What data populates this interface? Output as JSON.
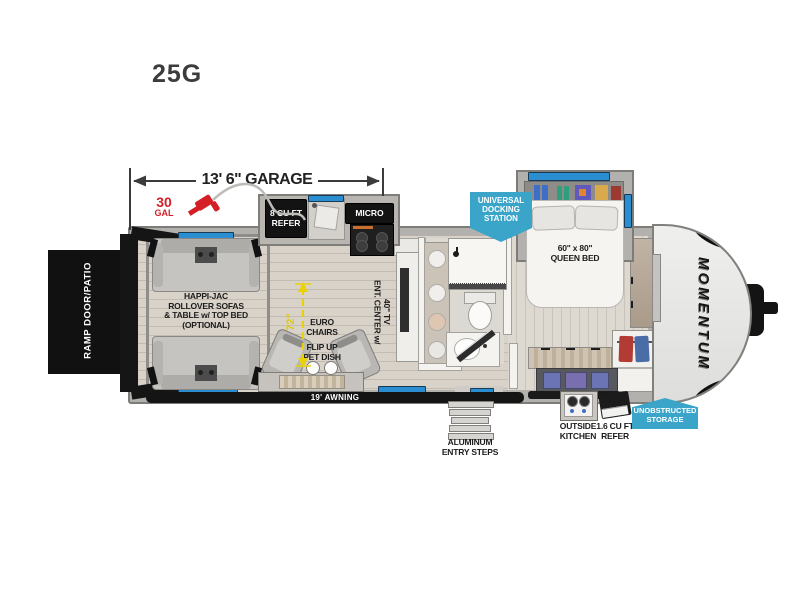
{
  "model": "25G",
  "brand_logo": "MOMENTUM",
  "dimensions": {
    "garage": "13' 6\" GARAGE",
    "fuel_value": "30",
    "fuel_unit": "GAL",
    "interior_height": "72\"",
    "awning": "19' AWNING"
  },
  "badges": {
    "docking": "UNIVERSAL\nDOCKING\nSTATION",
    "storage": "UNOBSTRUCTED\nSTORAGE"
  },
  "labels": {
    "ramp": "RAMP DOOR/PATIO",
    "garage_sofas": "HAPPI-JAC\nROLLOVER SOFAS\n& TABLE w/ TOP BED\n(OPTIONAL)",
    "refer": "8 CU FT\nREFER",
    "micro": "MICRO",
    "euro_chairs": "EURO\nCHAIRS",
    "pet_dish": "FLIP UP\nPET DISH",
    "ent_center": "ENT. CENTER w/\n40\" TV",
    "queen_bed": "60\" x 80\"\nQUEEN BED",
    "steps": "ALUMINUM\nENTRY STEPS",
    "outside_kitchen": "OUTSIDE\nKITCHEN",
    "outside_refer": "1.6 CU FT\nREFER"
  },
  "colors": {
    "badge_blue": "#3aa5c9",
    "accent_red": "#d31f26",
    "dimension_yellow": "#e9d106",
    "window_blue": "#2b8ed1"
  }
}
